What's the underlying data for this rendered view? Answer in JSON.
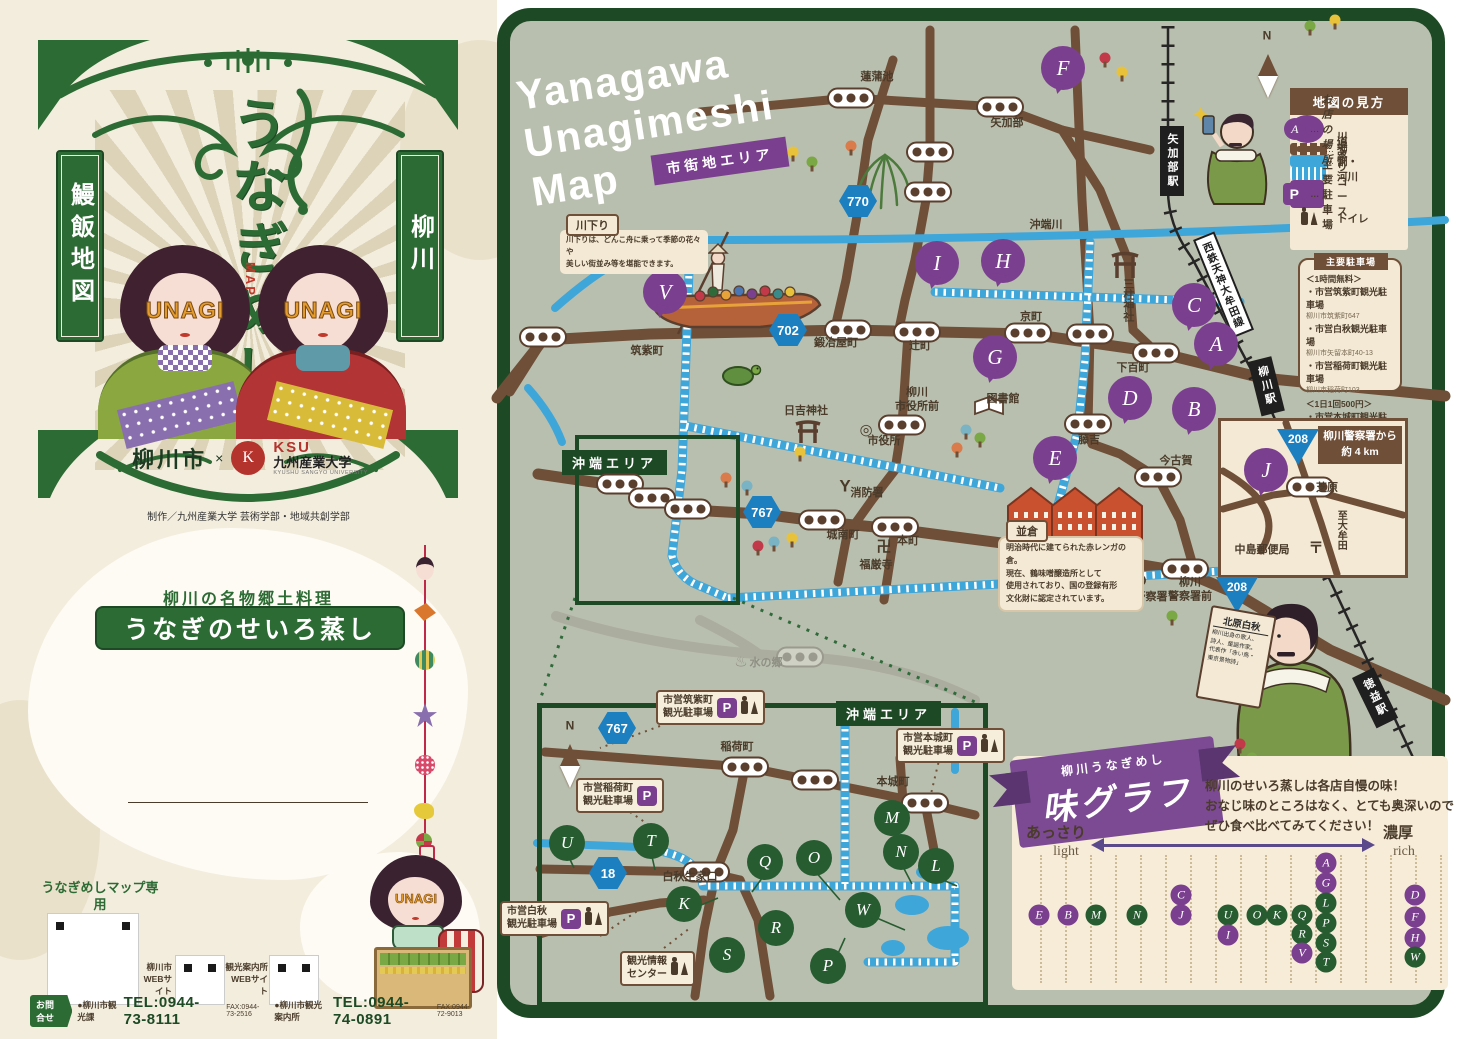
{
  "colors": {
    "cover_green": "#2d6b34",
    "frame_green": "#1d4a24",
    "map_bg": "#b9bfae",
    "road_brown": "#6f4f38",
    "canal_blue": "#3fa6d9",
    "accent_purple": "#7b3f8f",
    "marker_green": "#275c31",
    "panel_beige": "#f3e9d4"
  },
  "cover": {
    "banner_left": "鰻飯地図",
    "banner_right": "柳川",
    "title_chars": "うなぎめし",
    "map_mark": "MAP",
    "unagi": "UNAGI",
    "city": "柳川市",
    "cross": "×",
    "ksu": "KSU",
    "univ": "九州産業大学",
    "univ_en": "KYUSHU SANGYO UNIVERSITY",
    "credit": "制作／九州産業大学 芸術学部・地域共創学部"
  },
  "intro": {
    "lead": "柳川の名物郷土料理",
    "dish": "うなぎのせいろ蒸し",
    "body": [
      "柳川ではタレを絡めて味付けしたご飯の上に、",
      "蒲焼きにしたうなぎ、錦糸玉子を乗せ、",
      "せいろで蒸したものを提供します。",
      "うなぎは外はパリッと香ばしく、",
      "中はふわっと仕上がり、そのうま味がご飯にも染み、",
      "最後まで熱々のままお召し上がりいただけます。"
    ],
    "note": [
      "水郷・柳川は、古くから天然うなぎの名産地として広く知られ、江戸初期である1681年",
      "に柳川名物「うなぎのせいろ蒸し」が誕生しました。令和4年3月には文化庁の100年",
      "フード事業「伝統の100年フード部門−江戸時代から続く郷土料理−」に認定されました。"
    ]
  },
  "web": {
    "site1a": "うなぎめしマップ専用",
    "site1b": "WEBサイト",
    "site2": "柳川市\nWEBサイト",
    "site3": "観光案内所\nWEBサイト"
  },
  "contact": {
    "tag": "お問合せ",
    "o1": "●柳川市観光課",
    "t1": "TEL:0944-73-8111",
    "f1": "FAX:0944-73-2516",
    "o2": "●柳川市観光案内所",
    "t2": "TEL:0944-74-0891",
    "f2": "FAX:0944-72-9013"
  },
  "map": {
    "title1": "Yanagawa",
    "title2": "Unagimeshi",
    "title3": "Map",
    "area_tag": "市街地エリア",
    "okinohata": "沖端エリア",
    "rail_banner": "西鉄天神大牟田線",
    "kawakudari": {
      "tab": "川下り",
      "l1": "川下りは、どんこ舟に乗って季節の花々や",
      "l2": "美しい街並み等を堪能できます。"
    },
    "namikura": {
      "tab": "並倉",
      "l1": "明治時代に建てられた赤レンガの倉。",
      "l2": "現在、鶴味噌醸造所として",
      "l3": "使用されており、国の登録有形",
      "l4": "文化財に認定されています。"
    },
    "hakushu": {
      "title": "北原白秋",
      "l1": "柳川出身の歌人、",
      "l2": "詩人、童謡作家。",
      "l3": "代表作「赤い鳥・",
      "l4": "東京景物詩」"
    },
    "police": {
      "h1": "柳川警察署から",
      "h2": "約 4 km"
    },
    "stations": [
      {
        "t": "矢加部駅",
        "x": 1160,
        "y": 126
      },
      {
        "t": "柳川駅",
        "x": 1248,
        "y": 362,
        "r": -14
      },
      {
        "t": "徳益駅",
        "x": 1352,
        "y": 678,
        "r": -26
      }
    ],
    "shields": [
      {
        "t": "770",
        "x": 858,
        "y": 201
      },
      {
        "t": "702",
        "x": 788,
        "y": 330
      },
      {
        "t": "767",
        "x": 762,
        "y": 512
      },
      {
        "t": "767",
        "x": 617,
        "y": 728
      },
      {
        "t": "18",
        "x": 608,
        "y": 873
      }
    ],
    "triangles": [
      {
        "t": "208",
        "x": 1298,
        "y": 447
      },
      {
        "t": "208",
        "x": 1237,
        "y": 595
      }
    ],
    "markers": [
      {
        "l": "F",
        "x": 1063,
        "y": 68
      },
      {
        "l": "V",
        "x": 665,
        "y": 292
      },
      {
        "l": "I",
        "x": 937,
        "y": 263
      },
      {
        "l": "H",
        "x": 1003,
        "y": 261
      },
      {
        "l": "C",
        "x": 1194,
        "y": 305
      },
      {
        "l": "A",
        "x": 1216,
        "y": 344
      },
      {
        "l": "G",
        "x": 995,
        "y": 357
      },
      {
        "l": "B",
        "x": 1194,
        "y": 409
      },
      {
        "l": "D",
        "x": 1130,
        "y": 398
      },
      {
        "l": "E",
        "x": 1055,
        "y": 458
      },
      {
        "l": "J",
        "x": 1266,
        "y": 470
      }
    ],
    "gmarkers": [
      {
        "l": "U",
        "x": 567,
        "y": 843
      },
      {
        "l": "T",
        "x": 651,
        "y": 841
      },
      {
        "l": "Q",
        "x": 765,
        "y": 862
      },
      {
        "l": "O",
        "x": 814,
        "y": 858
      },
      {
        "l": "M",
        "x": 892,
        "y": 818
      },
      {
        "l": "N",
        "x": 901,
        "y": 852
      },
      {
        "l": "L",
        "x": 936,
        "y": 866
      },
      {
        "l": "K",
        "x": 684,
        "y": 904
      },
      {
        "l": "W",
        "x": 863,
        "y": 910
      },
      {
        "l": "R",
        "x": 776,
        "y": 928
      },
      {
        "l": "S",
        "x": 727,
        "y": 955
      },
      {
        "l": "P",
        "x": 828,
        "y": 966
      }
    ],
    "busstops": [
      {
        "x": 851,
        "y": 98
      },
      {
        "x": 1000,
        "y": 107
      },
      {
        "x": 930,
        "y": 152
      },
      {
        "x": 928,
        "y": 192
      },
      {
        "x": 543,
        "y": 337
      },
      {
        "x": 848,
        "y": 330
      },
      {
        "x": 917,
        "y": 332
      },
      {
        "x": 1028,
        "y": 333
      },
      {
        "x": 1090,
        "y": 334
      },
      {
        "x": 1156,
        "y": 353
      },
      {
        "x": 902,
        "y": 425
      },
      {
        "x": 1088,
        "y": 424
      },
      {
        "x": 1158,
        "y": 477
      },
      {
        "x": 1185,
        "y": 569
      },
      {
        "x": 822,
        "y": 520
      },
      {
        "x": 895,
        "y": 527
      },
      {
        "x": 620,
        "y": 484
      },
      {
        "x": 652,
        "y": 498
      },
      {
        "x": 688,
        "y": 509
      },
      {
        "x": 745,
        "y": 767
      },
      {
        "x": 815,
        "y": 780
      },
      {
        "x": 925,
        "y": 803
      },
      {
        "x": 706,
        "y": 872
      },
      {
        "x": 1310,
        "y": 487
      },
      {
        "x": 800,
        "y": 657,
        "cls": "ghost"
      }
    ],
    "labels": [
      {
        "t": "蓮蒲池",
        "x": 877,
        "y": 78
      },
      {
        "t": "矢加部",
        "x": 1007,
        "y": 124
      },
      {
        "t": "沖端川",
        "x": 1046,
        "y": 226
      },
      {
        "t": "筑紫町",
        "x": 647,
        "y": 352
      },
      {
        "t": "鍛冶屋町",
        "x": 836,
        "y": 344
      },
      {
        "t": "辻町",
        "x": 920,
        "y": 347
      },
      {
        "t": "京町",
        "x": 1031,
        "y": 318
      },
      {
        "t": "下百町",
        "x": 1133,
        "y": 369
      },
      {
        "t": "三柱神社",
        "x": 1127,
        "y": 300,
        "v": 1
      },
      {
        "t": "柳川\n市役所前",
        "x": 917,
        "y": 400
      },
      {
        "t": "図書館",
        "x": 1003,
        "y": 400
      },
      {
        "t": "市役所",
        "x": 884,
        "y": 442
      },
      {
        "t": "日吉神社",
        "x": 806,
        "y": 412
      },
      {
        "t": "消防署",
        "x": 867,
        "y": 494
      },
      {
        "t": "城南町",
        "x": 843,
        "y": 536
      },
      {
        "t": "本町",
        "x": 908,
        "y": 542
      },
      {
        "t": "福厳寺",
        "x": 876,
        "y": 566
      },
      {
        "t": "藤吉",
        "x": 1089,
        "y": 441
      },
      {
        "t": "今古賀",
        "x": 1176,
        "y": 462
      },
      {
        "t": "柳川警察署",
        "x": 1140,
        "y": 598
      },
      {
        "t": "柳川\n警察署前",
        "x": 1190,
        "y": 590
      },
      {
        "t": "水の郷",
        "x": 766,
        "y": 664,
        "cls": "ghost"
      },
      {
        "t": "稲荷町",
        "x": 737,
        "y": 748
      },
      {
        "t": "本城町",
        "x": 893,
        "y": 783
      },
      {
        "t": "白秋生家口",
        "x": 690,
        "y": 878
      },
      {
        "t": "芝原",
        "x": 1327,
        "y": 489
      },
      {
        "t": "中島郵便局",
        "x": 1262,
        "y": 551
      },
      {
        "t": "至大牟田",
        "x": 1340,
        "y": 530,
        "v": 1,
        "s": 10
      },
      {
        "t": "◎",
        "x": 866,
        "y": 431,
        "cls": "sym"
      },
      {
        "t": "卍",
        "x": 884,
        "y": 548,
        "cls": "sym"
      },
      {
        "t": "〒",
        "x": 1316,
        "y": 549,
        "cls": "sym"
      },
      {
        "t": "♨",
        "x": 741,
        "y": 663,
        "cls": "sym ghost"
      },
      {
        "t": "Y",
        "x": 845,
        "y": 486,
        "cls": "sym",
        "s": 17
      },
      {
        "t": "⊗",
        "x": 1140,
        "y": 580,
        "cls": "sym",
        "s": 18
      },
      {
        "t": "N",
        "x": 1267,
        "y": 36,
        "cls": "north"
      },
      {
        "t": "N",
        "x": 570,
        "y": 726,
        "cls": "north"
      }
    ],
    "legend": {
      "title": "地図の見方",
      "items": [
        {
          "cls": "ic-shop",
          "glyph": "A",
          "d": "…",
          "label": "お店の場所"
        },
        {
          "cls": "ic-road",
          "d": "…",
          "label": "道路"
        },
        {
          "cls": "ic-canal",
          "d": "…",
          "label": "堀割・河川"
        },
        {
          "cls": "ic-cruise",
          "d": "…",
          "label": "川下りコース"
        },
        {
          "cls": "ic-park",
          "glyph": "P",
          "d": "…",
          "label": "主要駐車場"
        },
        {
          "cls": "ic-wc",
          "d": "…",
          "label": "トイレ"
        }
      ]
    },
    "parking": {
      "title": "主要駐車場",
      "rows": [
        {
          "t": "＜1時間無料＞",
          "cls": "p-hdr"
        },
        {
          "t": "・市営筑紫町観光駐車場",
          "cls": "p-name"
        },
        {
          "t": "柳川市筑紫町647",
          "cls": "p-addr"
        },
        {
          "t": "・市営白秋観光駐車場",
          "cls": "p-name"
        },
        {
          "t": "柳川市矢留本町40-13",
          "cls": "p-addr"
        },
        {
          "t": "・市営稲荷町観光駐車場",
          "cls": "p-name"
        },
        {
          "t": "柳川市稲荷町103",
          "cls": "p-addr"
        },
        {
          "t": "＜1日1回500円＞",
          "cls": "p-hdr"
        },
        {
          "t": "・市営本城町観光駐車場",
          "cls": "p-name"
        },
        {
          "t": "柳川市本城町 58-7",
          "cls": "p-addr"
        }
      ]
    },
    "pboxes": [
      {
        "t": "市営筑紫町\n観光駐車場",
        "x": 656,
        "y": 690,
        "p": "P"
      },
      {
        "t": "市営本城町\n観光駐車場",
        "x": 896,
        "y": 728,
        "p": "P"
      },
      {
        "t": "市営稲荷町\n観光駐車場",
        "x": 576,
        "y": 778,
        "p": "P",
        "cls": "no-wc"
      },
      {
        "t": "市営白秋\n観光駐車場",
        "x": 500,
        "y": 901,
        "p": "P"
      },
      {
        "t": "観光情報\nセンター",
        "x": 620,
        "y": 951,
        "cls": "no-p"
      }
    ],
    "taste": {
      "r1": "柳川うなぎめし",
      "r2": "味グラフ",
      "d1": "柳川のせいろ蒸しは各店自慢の味！",
      "d2": "おなじ味のところはなく、とても奥深いので",
      "d3": "ぜひ食べ比べてみてください！",
      "left1": "あっさり",
      "left2": "light",
      "right1": "濃厚",
      "right2": "rich",
      "letters": [
        {
          "l": "E",
          "x": 1039,
          "y": 915,
          "cls": "p"
        },
        {
          "l": "B",
          "x": 1068,
          "y": 915,
          "cls": "p"
        },
        {
          "l": "M",
          "x": 1096,
          "y": 915,
          "cls": "g"
        },
        {
          "l": "N",
          "x": 1137,
          "y": 915,
          "cls": "g"
        },
        {
          "l": "C",
          "x": 1181,
          "y": 895,
          "cls": "p"
        },
        {
          "l": "J",
          "x": 1181,
          "y": 915,
          "cls": "p"
        },
        {
          "l": "U",
          "x": 1228,
          "y": 915,
          "cls": "g"
        },
        {
          "l": "I",
          "x": 1228,
          "y": 935,
          "cls": "p"
        },
        {
          "l": "O",
          "x": 1257,
          "y": 915,
          "cls": "g"
        },
        {
          "l": "K",
          "x": 1277,
          "y": 915,
          "cls": "g"
        },
        {
          "l": "Q",
          "x": 1302,
          "y": 915,
          "cls": "g"
        },
        {
          "l": "R",
          "x": 1302,
          "y": 934,
          "cls": "g"
        },
        {
          "l": "V",
          "x": 1302,
          "y": 953,
          "cls": "p"
        },
        {
          "l": "A",
          "x": 1326,
          "y": 863,
          "cls": "p"
        },
        {
          "l": "G",
          "x": 1326,
          "y": 883,
          "cls": "p"
        },
        {
          "l": "L",
          "x": 1326,
          "y": 903,
          "cls": "g"
        },
        {
          "l": "P",
          "x": 1326,
          "y": 923,
          "cls": "g"
        },
        {
          "l": "S",
          "x": 1326,
          "y": 943,
          "cls": "g"
        },
        {
          "l": "T",
          "x": 1326,
          "y": 962,
          "cls": "g"
        },
        {
          "l": "D",
          "x": 1415,
          "y": 895,
          "cls": "p"
        },
        {
          "l": "F",
          "x": 1415,
          "y": 917,
          "cls": "p"
        },
        {
          "l": "H",
          "x": 1415,
          "y": 938,
          "cls": "p"
        },
        {
          "l": "W",
          "x": 1415,
          "y": 957,
          "cls": "g"
        }
      ]
    },
    "trees": [
      {
        "x": 793,
        "y": 152,
        "c": "#e8c23a"
      },
      {
        "x": 812,
        "y": 162,
        "c": "#7aa845"
      },
      {
        "x": 851,
        "y": 146,
        "c": "#d97b4a"
      },
      {
        "x": 726,
        "y": 478,
        "c": "#d97b4a"
      },
      {
        "x": 747,
        "y": 486,
        "c": "#7ab3c4"
      },
      {
        "x": 800,
        "y": 452,
        "c": "#e8c23a"
      },
      {
        "x": 792,
        "y": 538,
        "c": "#e8c23a"
      },
      {
        "x": 758,
        "y": 546,
        "c": "#c23a4a"
      },
      {
        "x": 774,
        "y": 542,
        "c": "#7ab3c4"
      },
      {
        "x": 966,
        "y": 430,
        "c": "#7ab3c4"
      },
      {
        "x": 980,
        "y": 438,
        "c": "#7aa845"
      },
      {
        "x": 957,
        "y": 448,
        "c": "#d97b4a"
      },
      {
        "x": 1079,
        "y": 560,
        "c": "#e8c23a"
      },
      {
        "x": 1094,
        "y": 570,
        "c": "#7ab3c4"
      },
      {
        "x": 1064,
        "y": 574,
        "c": "#d97b4a"
      },
      {
        "x": 1172,
        "y": 616,
        "c": "#7aa845"
      },
      {
        "x": 1240,
        "y": 744,
        "c": "#c23a4a"
      },
      {
        "x": 1252,
        "y": 758,
        "c": "#7aa845"
      },
      {
        "x": 1105,
        "y": 58,
        "c": "#c23a4a"
      },
      {
        "x": 1122,
        "y": 72,
        "c": "#e8c23a"
      },
      {
        "x": 1310,
        "y": 26,
        "c": "#7aa845"
      },
      {
        "x": 1335,
        "y": 20,
        "c": "#e8c23a"
      }
    ]
  }
}
